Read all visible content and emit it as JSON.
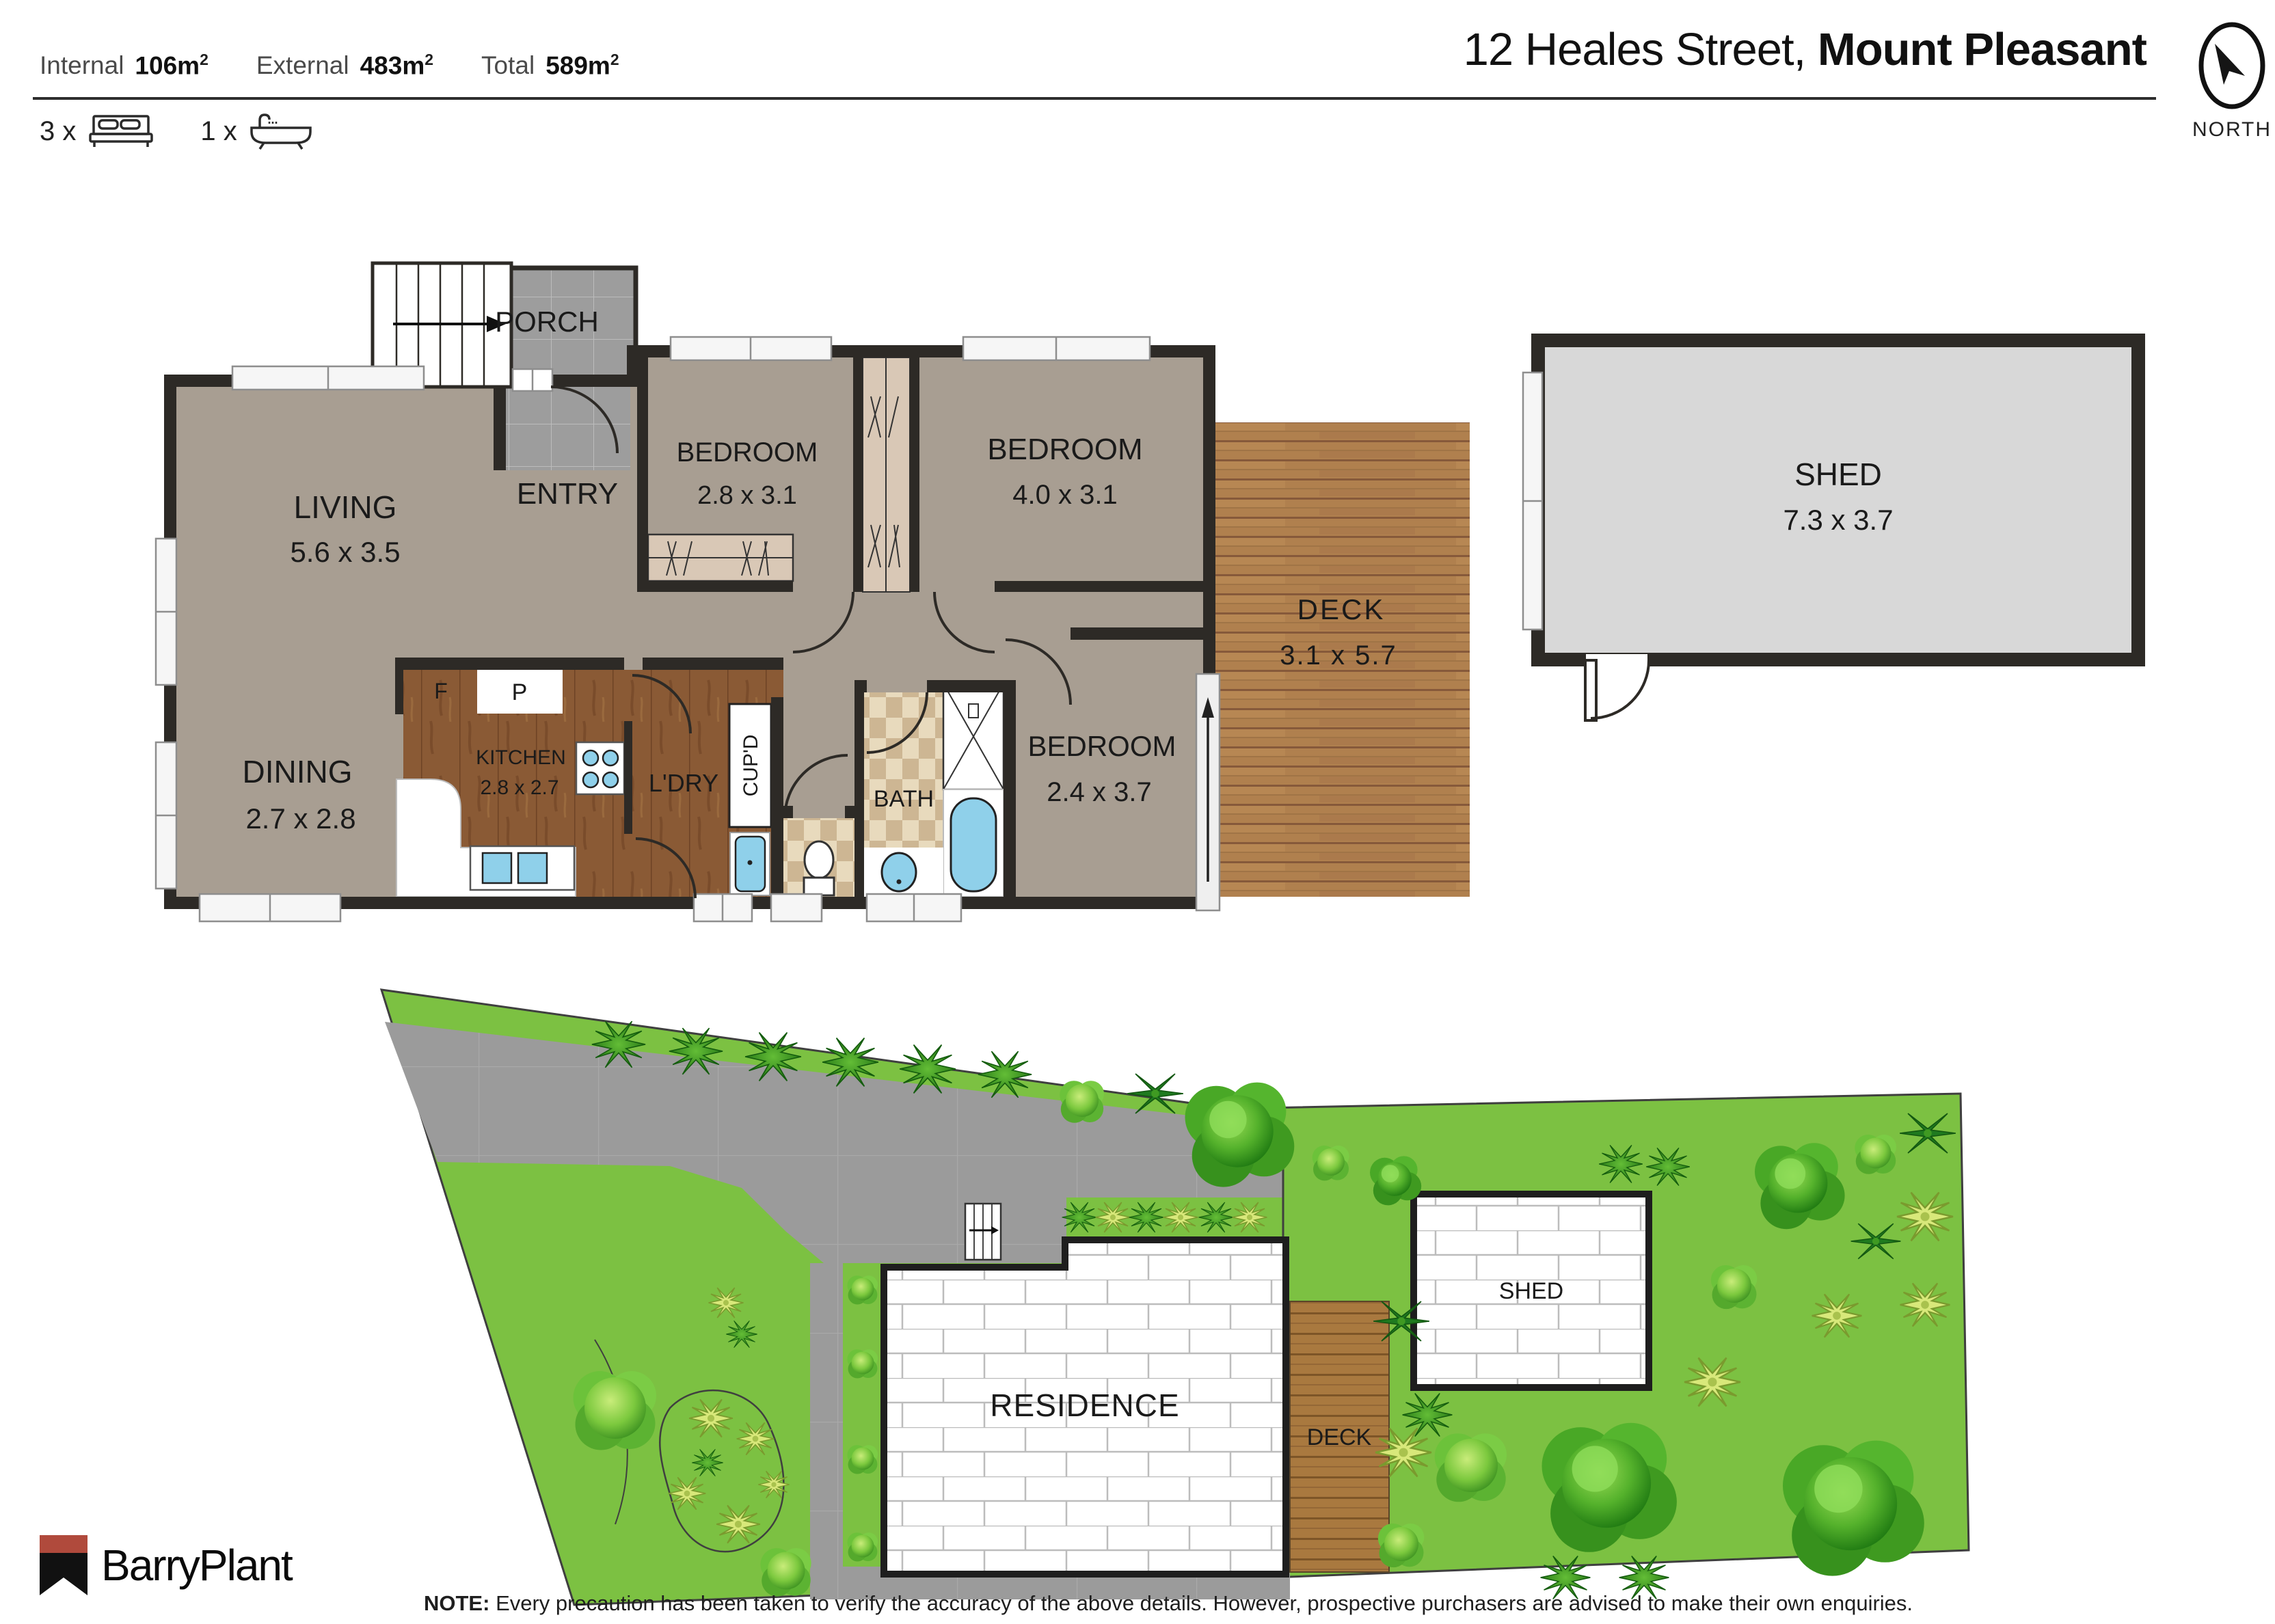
{
  "header": {
    "stats": [
      {
        "label": "Internal",
        "value": "106m",
        "sup": "2"
      },
      {
        "label": "External",
        "value": "483m",
        "sup": "2"
      },
      {
        "label": "Total",
        "value": "589m",
        "sup": "2"
      }
    ],
    "beds_count": "3 x",
    "baths_count": "1 x",
    "title": {
      "street": "12 Heales Street,",
      "suburb": "Mount Pleasant"
    },
    "compass_label": "NORTH"
  },
  "floorplan": {
    "porch": {
      "name": "PORCH"
    },
    "entry": {
      "name": "ENTRY"
    },
    "living": {
      "name": "LIVING",
      "dims": "5.6 x 3.5"
    },
    "dining": {
      "name": "DINING",
      "dims": "2.7 x 2.8"
    },
    "bedroom1": {
      "name": "BEDROOM",
      "dims": "2.8 x 3.1"
    },
    "bedroom2": {
      "name": "BEDROOM",
      "dims": "4.0 x 3.1"
    },
    "bedroom3": {
      "name": "BEDROOM",
      "dims": "2.4 x 3.7"
    },
    "kitchen": {
      "name": "KITCHEN",
      "dims": "2.8 x 2.7"
    },
    "fridge_label": "F",
    "pantry_label": "P",
    "laundry_label": "L'DRY",
    "cupboard_label": "CUP'D",
    "bath_label": "BATH",
    "deck": {
      "name": "DECK",
      "dims": "3.1 x 5.7"
    },
    "shed": {
      "name": "SHED",
      "dims": "7.3 x 3.7"
    }
  },
  "siteplan": {
    "residence_label": "RESIDENCE",
    "deck_label": "DECK",
    "shed_label": "SHED"
  },
  "footer": {
    "brand": "BarryPlant",
    "note_label": "NOTE:",
    "note_text": "Every precaution has been taken to verify the accuracy of the above details. However, prospective purchasers are advised to make their own enquiries."
  },
  "colors": {
    "wall": "#2d2a26",
    "floor_main": "#a89e92",
    "tile_gray": "#9d9d9d",
    "kitchen_wood": "#8a5a35",
    "deck_wood": "#b0804e",
    "fixture_blue": "#8fd0ea",
    "site_green": "#7cc142",
    "driveway_gray": "#9b9b9b",
    "logo_red": "#b04a3c"
  }
}
